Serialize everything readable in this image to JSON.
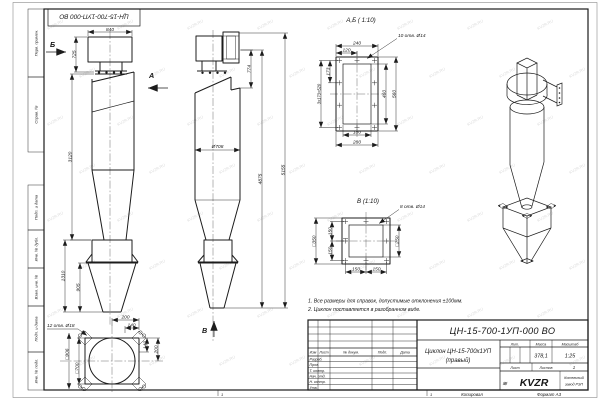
{
  "frame": {
    "stamp_top": "ЦН-15-700-1УП-000 ВО",
    "side_labels": [
      "Перв. примен.",
      "Справ. №",
      "Подп. и дата",
      "Инв. № дубл.",
      "Взам. инв. №",
      "Подп. и дата",
      "Инв. № подл."
    ],
    "zone1": "1",
    "zone2": "1",
    "copied": "Копировал",
    "format": "Формат А3"
  },
  "watermark": {
    "text": "KVZR.RU"
  },
  "side": {
    "label_b": "Б",
    "label_a": "А",
    "d840": "840",
    "d725": "725",
    "d3120": "3120",
    "d1310": "1310",
    "d905": "905"
  },
  "front": {
    "label_v": "В",
    "d774": "774",
    "d708": "Ø708",
    "d4875": "4875",
    "d5155": "5155"
  },
  "ab": {
    "title": "А,Б ( 1:10)",
    "holes": "10 отв. Ø14",
    "d240": "240",
    "d120": "120",
    "d173": "173",
    "d520": "3x173=520",
    "d460": "460",
    "d560": "560",
    "d180": "180",
    "d280": "280"
  },
  "v": {
    "title": "В (1:10)",
    "holes": "8 отв. Ø14",
    "d350": "□350",
    "d250": "□250",
    "d150a": "150",
    "d150b": "150",
    "d150c": "150",
    "d150d": "150"
  },
  "bottom": {
    "holes": "12 отв. Ø18",
    "d200a": "200",
    "d140a": "140",
    "d140b": "140",
    "d200b": "200",
    "d906": "□906",
    "d700": "□700"
  },
  "notes": {
    "n1": "1. Все размеры для справок, допустимые отклонения ±100мм.",
    "n2": "2. Циклон поставляется в разобранном виде."
  },
  "tb": {
    "doc": "ЦН-15-700-1УП-000 ВО",
    "name1": "Циклон ЦН-15-700х1УП",
    "name2": "(правый)",
    "izm": "Изм",
    "list": "Лист",
    "doku": "№ докум.",
    "podp": "Подп.",
    "data": "Дата",
    "rows": [
      "Разраб.",
      "Пров.",
      "Т. контр.",
      "Нач. отд.",
      "Н. контр.",
      "Утв."
    ],
    "lit": "Лит.",
    "massa": "Масса",
    "masshtab": "Масштаб",
    "mass_val": "378,1",
    "scale_val": "1:25",
    "sheet": "Лист",
    "sheets": "Листов",
    "sheets_val": "1",
    "logo_mark": "≋",
    "logo": "KVZR",
    "co1": "Котельный",
    "co2": "завод РЭП"
  }
}
